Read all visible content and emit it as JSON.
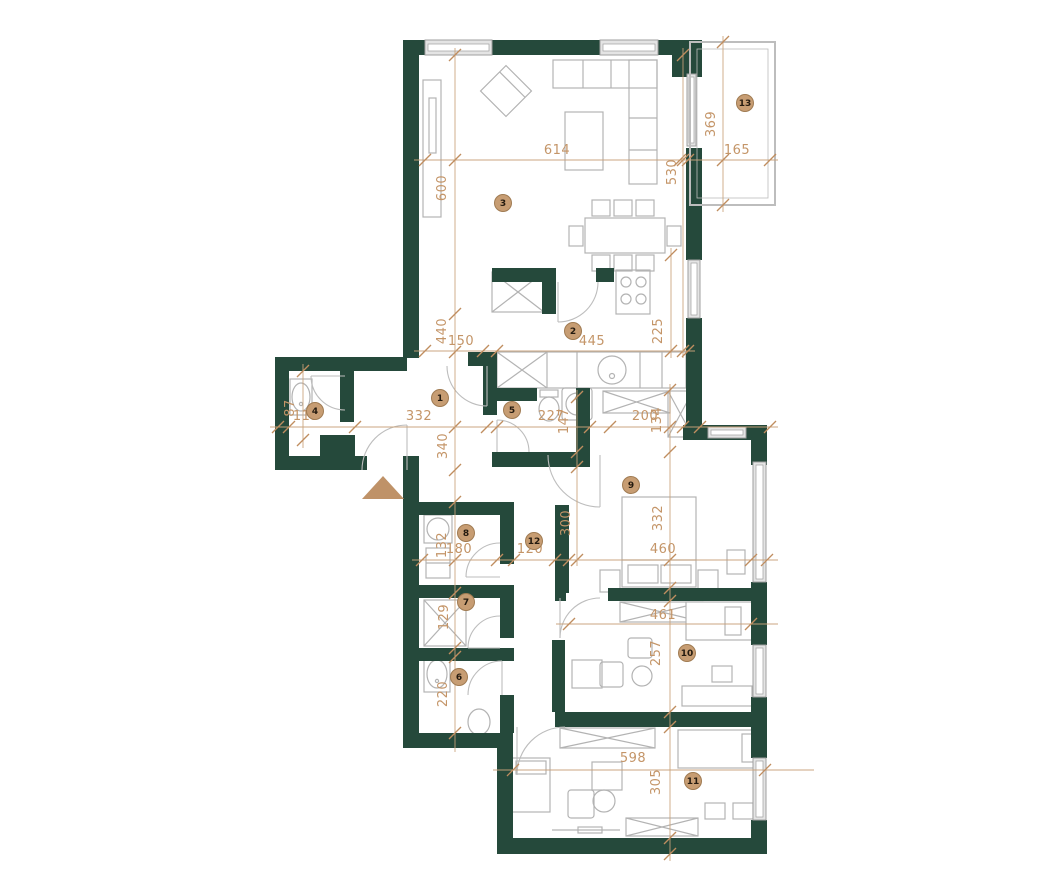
{
  "plan": {
    "colors": {
      "wall": "#25493B",
      "dimension": "#C49568",
      "marker_fill": "#C79D73",
      "marker_stroke": "#A07B52",
      "furniture": "#B3B3B3",
      "entrance_arrow": "#BF9268"
    },
    "room_markers": [
      {
        "num": "1",
        "x": 440,
        "y": 398
      },
      {
        "num": "2",
        "x": 573,
        "y": 331
      },
      {
        "num": "3",
        "x": 503,
        "y": 203
      },
      {
        "num": "4",
        "x": 315,
        "y": 411
      },
      {
        "num": "5",
        "x": 512,
        "y": 410
      },
      {
        "num": "6",
        "x": 459,
        "y": 677
      },
      {
        "num": "7",
        "x": 466,
        "y": 602
      },
      {
        "num": "8",
        "x": 466,
        "y": 533
      },
      {
        "num": "9",
        "x": 631,
        "y": 485
      },
      {
        "num": "10",
        "x": 687,
        "y": 653
      },
      {
        "num": "11",
        "x": 693,
        "y": 781
      },
      {
        "num": "12",
        "x": 534,
        "y": 541
      },
      {
        "num": "13",
        "x": 745,
        "y": 103
      }
    ],
    "dimensions": [
      {
        "label": "614",
        "x": 557,
        "y": 154,
        "rot": 0
      },
      {
        "label": "600",
        "x": 446,
        "y": 188,
        "rot": -90
      },
      {
        "label": "530",
        "x": 676,
        "y": 172,
        "rot": -90
      },
      {
        "label": "369",
        "x": 715,
        "y": 124,
        "rot": -90
      },
      {
        "label": "165",
        "x": 737,
        "y": 154,
        "rot": 0
      },
      {
        "label": "445",
        "x": 592,
        "y": 345,
        "rot": 0
      },
      {
        "label": "150",
        "x": 461,
        "y": 345,
        "rot": 0
      },
      {
        "label": "440",
        "x": 446,
        "y": 331,
        "rot": -90
      },
      {
        "label": "225",
        "x": 662,
        "y": 331,
        "rot": -90
      },
      {
        "label": "119",
        "x": 306,
        "y": 420,
        "rot": 0
      },
      {
        "label": "87",
        "x": 294,
        "y": 408,
        "rot": -90
      },
      {
        "label": "332",
        "x": 419,
        "y": 420,
        "rot": 0
      },
      {
        "label": "340",
        "x": 447,
        "y": 446,
        "rot": -90
      },
      {
        "label": "227",
        "x": 551,
        "y": 420,
        "rot": 0
      },
      {
        "label": "147",
        "x": 568,
        "y": 421,
        "rot": -90
      },
      {
        "label": "200",
        "x": 645,
        "y": 420,
        "rot": 0
      },
      {
        "label": "134",
        "x": 661,
        "y": 420,
        "rot": -90
      },
      {
        "label": "180",
        "x": 459,
        "y": 553,
        "rot": 0
      },
      {
        "label": "132",
        "x": 446,
        "y": 545,
        "rot": -90
      },
      {
        "label": "120",
        "x": 530,
        "y": 553,
        "rot": 0
      },
      {
        "label": "300",
        "x": 570,
        "y": 523,
        "rot": -90
      },
      {
        "label": "460",
        "x": 663,
        "y": 553,
        "rot": 0
      },
      {
        "label": "332",
        "x": 662,
        "y": 518,
        "rot": -90
      },
      {
        "label": "129",
        "x": 448,
        "y": 617,
        "rot": -90
      },
      {
        "label": "220",
        "x": 447,
        "y": 694,
        "rot": -90
      },
      {
        "label": "461",
        "x": 663,
        "y": 619,
        "rot": 0
      },
      {
        "label": "257",
        "x": 660,
        "y": 653,
        "rot": -90
      },
      {
        "label": "598",
        "x": 633,
        "y": 762,
        "rot": 0
      },
      {
        "label": "305",
        "x": 660,
        "y": 782,
        "rot": -90
      }
    ],
    "dim_lines": [
      {
        "x1": 414,
        "y1": 160,
        "x2": 778,
        "y2": 160,
        "ticks": [
          [
            425,
            160
          ],
          [
            680,
            160
          ],
          [
            688,
            160
          ],
          [
            770,
            160
          ]
        ]
      },
      {
        "x1": 455,
        "y1": 48,
        "x2": 455,
        "y2": 752,
        "ticks": [
          [
            455,
            55
          ],
          [
            455,
            160
          ],
          [
            455,
            314
          ],
          [
            455,
            352
          ],
          [
            455,
            427
          ],
          [
            455,
            470
          ],
          [
            455,
            502
          ],
          [
            455,
            560
          ],
          [
            455,
            593
          ],
          [
            455,
            648
          ],
          [
            455,
            657
          ],
          [
            455,
            733
          ]
        ]
      },
      {
        "x1": 683,
        "y1": 48,
        "x2": 683,
        "y2": 358,
        "ticks": [
          [
            683,
            55
          ],
          [
            683,
            160
          ],
          [
            683,
            351
          ]
        ]
      },
      {
        "x1": 723,
        "y1": 36,
        "x2": 723,
        "y2": 212,
        "ticks": [
          [
            723,
            42
          ],
          [
            723,
            160
          ],
          [
            723,
            205
          ]
        ]
      },
      {
        "x1": 414,
        "y1": 351,
        "x2": 695,
        "y2": 351,
        "ticks": [
          [
            425,
            351
          ],
          [
            483,
            351
          ],
          [
            497,
            351
          ],
          [
            688,
            351
          ]
        ]
      },
      {
        "x1": 671,
        "y1": 248,
        "x2": 671,
        "y2": 358,
        "ticks": [
          [
            671,
            255
          ],
          [
            671,
            351
          ]
        ]
      },
      {
        "x1": 270,
        "y1": 427,
        "x2": 778,
        "y2": 427,
        "ticks": [
          [
            278,
            427
          ],
          [
            289,
            427
          ],
          [
            355,
            427
          ],
          [
            487,
            427
          ],
          [
            497,
            427
          ],
          [
            590,
            427
          ],
          [
            610,
            427
          ],
          [
            683,
            427
          ],
          [
            700,
            427
          ],
          [
            770,
            427
          ]
        ]
      },
      {
        "x1": 303,
        "y1": 364,
        "x2": 303,
        "y2": 448,
        "ticks": [
          [
            303,
            371
          ],
          [
            303,
            440
          ]
        ]
      },
      {
        "x1": 577,
        "y1": 390,
        "x2": 577,
        "y2": 566,
        "ticks": [
          [
            577,
            397
          ],
          [
            577,
            452
          ],
          [
            577,
            467
          ],
          [
            577,
            560
          ]
        ]
      },
      {
        "x1": 670,
        "y1": 384,
        "x2": 670,
        "y2": 861,
        "ticks": [
          [
            670,
            390
          ],
          [
            670,
            427
          ],
          [
            670,
            452
          ],
          [
            670,
            560
          ],
          [
            670,
            588
          ],
          [
            670,
            601
          ],
          [
            670,
            712
          ],
          [
            670,
            727
          ],
          [
            670,
            838
          ],
          [
            670,
            854
          ]
        ]
      },
      {
        "x1": 412,
        "y1": 560,
        "x2": 778,
        "y2": 560,
        "ticks": [
          [
            422,
            560
          ],
          [
            497,
            560
          ],
          [
            514,
            560
          ],
          [
            555,
            560
          ],
          [
            569,
            560
          ],
          [
            751,
            560
          ],
          [
            767,
            560
          ]
        ]
      },
      {
        "x1": 556,
        "y1": 624,
        "x2": 778,
        "y2": 624,
        "ticks": [
          [
            569,
            624
          ],
          [
            751,
            624
          ]
        ]
      },
      {
        "x1": 493,
        "y1": 770,
        "x2": 814,
        "y2": 770,
        "ticks": [
          [
            513,
            770
          ],
          [
            765,
            770
          ]
        ]
      }
    ],
    "entrance_arrow": {
      "points": "383,476 404,499 362,499"
    }
  }
}
